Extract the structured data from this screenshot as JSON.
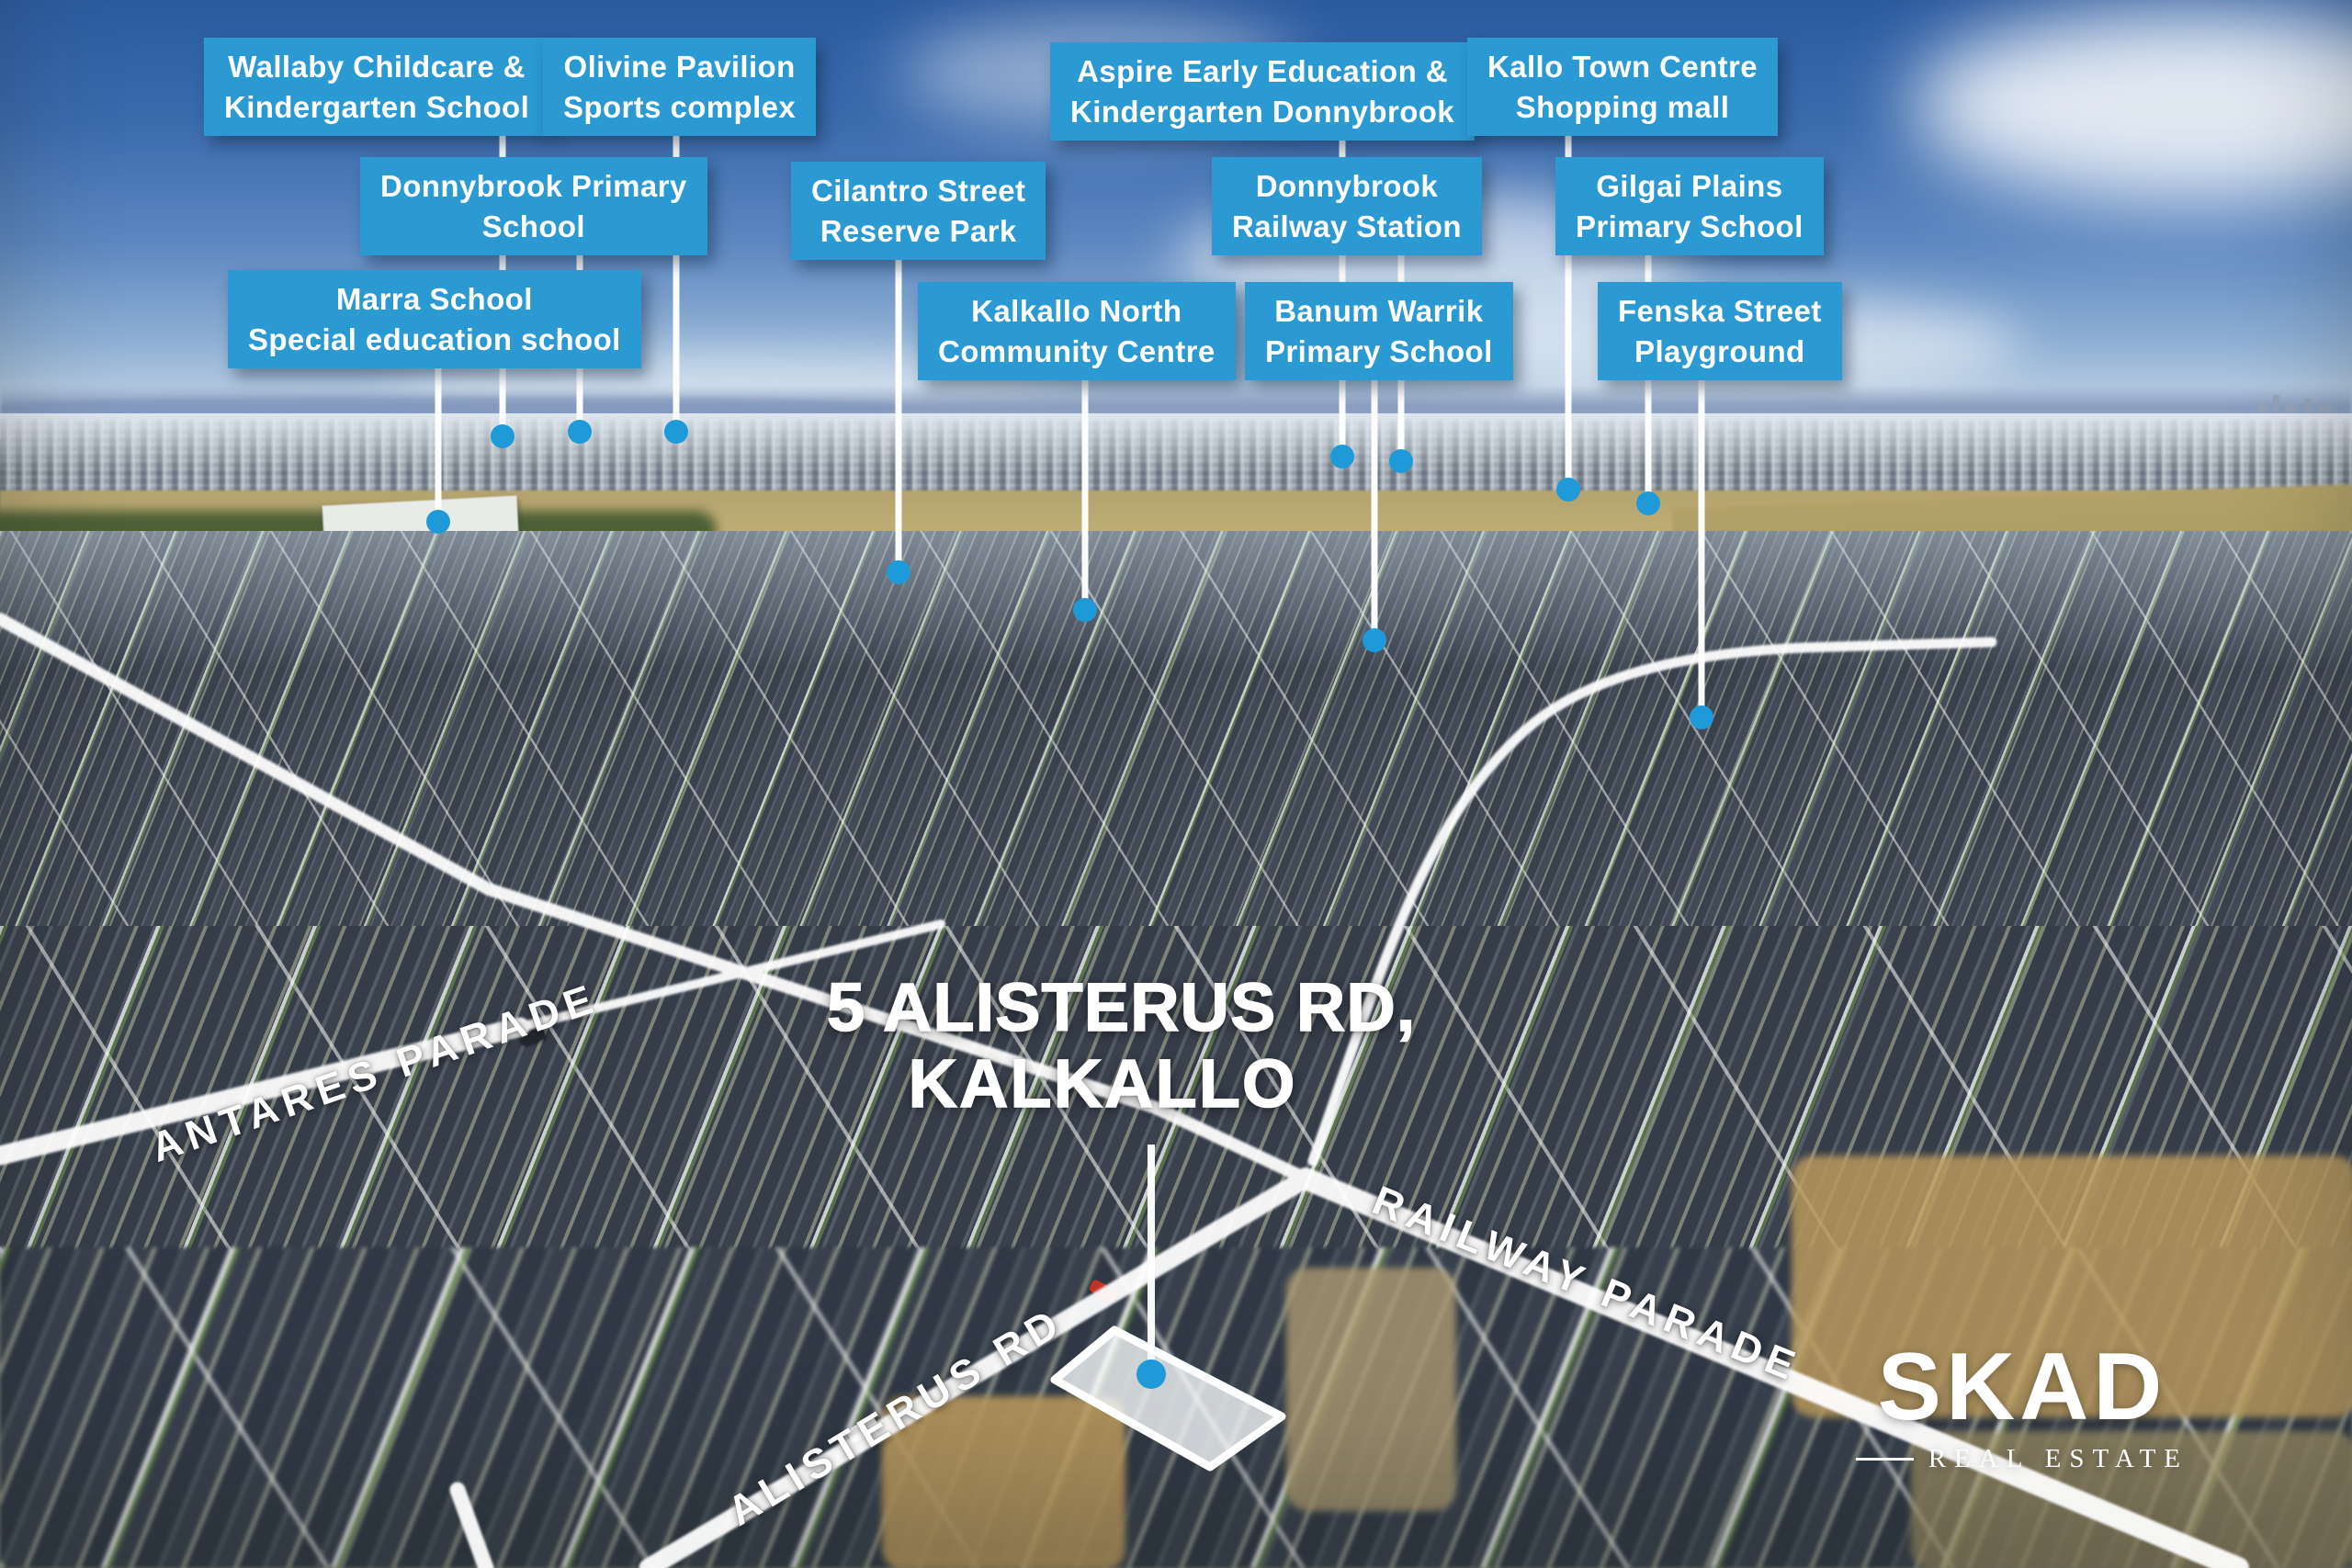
{
  "title": {
    "line1": "5 ALISTERUS RD,",
    "line2": "KALKALLO"
  },
  "callouts": {
    "wallaby": {
      "line1": "Wallaby Childcare &",
      "line2": "Kindergarten School"
    },
    "olivine": {
      "line1": "Olivine Pavilion",
      "line2": "Sports complex"
    },
    "aspire": {
      "line1": "Aspire Early Education &",
      "line2": "Kindergarten Donnybrook"
    },
    "kallo": {
      "line1": "Kallo Town Centre",
      "line2": "Shopping mall"
    },
    "donnybrook_primary": {
      "line1": "Donnybrook Primary",
      "line2": "School"
    },
    "cilantro": {
      "line1": "Cilantro Street",
      "line2": "Reserve Park"
    },
    "donnybrook_railway": {
      "line1": "Donnybrook",
      "line2": "Railway Station"
    },
    "gilgai": {
      "line1": "Gilgai Plains",
      "line2": "Primary School"
    },
    "marra": {
      "line1": "Marra School",
      "line2": "Special education school"
    },
    "kalkallo_north": {
      "line1": "Kalkallo North",
      "line2": "Community Centre"
    },
    "banum": {
      "line1": "Banum Warrik",
      "line2": "Primary School"
    },
    "fenska": {
      "line1": "Fenska Street",
      "line2": "Playground"
    }
  },
  "streets": {
    "antares": "ANTARES PARADE",
    "railway": "RAILWAY PARADE",
    "alisterus": "ALISTERUS RD"
  },
  "logo": {
    "brand": "SKAD",
    "tagline": "REAL ESTATE"
  },
  "colors": {
    "callout_bg": "#2b99d2",
    "marker_dot": "#1e9ad8",
    "leader_line": "#ffffff",
    "road_highlight": "#ffffff",
    "label_text": "#ffffff"
  }
}
